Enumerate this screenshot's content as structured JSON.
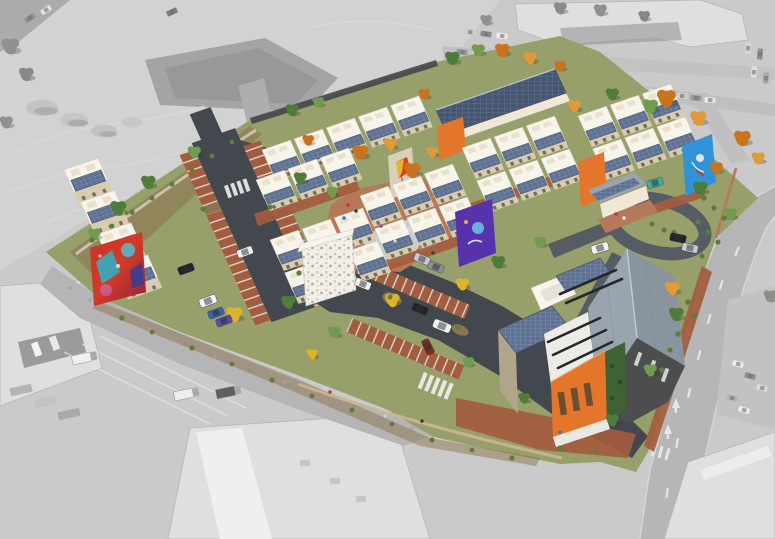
{
  "scene": {
    "type": "aerial-architectural-rendering",
    "context_style": "desaturated-grayscale-photo",
    "site_style": "full-color-rendered-development",
    "site": {
      "townhouse_clusters": 7,
      "apartment_building_left": 1,
      "community_building_corner": 1,
      "clubhouse": 1,
      "rowhouse_with_large_solar_roof": 1,
      "murals": [
        "abstract-red-teal-left",
        "purple-figure-center",
        "blue-figure-right",
        "kite-wall-center",
        "stone-mosaic-end-wall"
      ],
      "rooftop_solar_panels": true,
      "basketball_half_court": true,
      "central_plaza_with_people": true,
      "cul_de_sac_loop": true,
      "parking_lots": 2,
      "autumn_and_green_trees": true
    },
    "context": {
      "features": [
        "graded-dirt-pad-top-left",
        "commercial-building-with-parking-top-right",
        "arterial-street-right",
        "industrial-yard-with-trucks-bottom-left",
        "large-warehouse-roofs-bottom"
      ]
    }
  },
  "palette": {
    "bg_gray": "#cacaca",
    "dirt_light": "#d2d2d2",
    "pad_gray": "#a4a4a4",
    "street_gray": "#b6b6b6",
    "site_lawn": "#97a06b",
    "shrub_green": "#5e7c3e",
    "mulch_brown": "#8e7352",
    "rust_paving": "#a35c3e",
    "rust_light": "#b5795a",
    "asphalt": "#43484f",
    "asphalt_light": "#565c64",
    "court_gray": "#c7ccce",
    "cream_wall": "#f0e8d4",
    "cream_shade": "#d8ccb0",
    "roof_white": "#f7f4ec",
    "solar_blue": "#5e7191",
    "solar_grid": "#8ea0bf",
    "solar_dark": "#46566e",
    "accent_orange": "#e4762b",
    "accent_purple": "#5733ab",
    "accent_blue": "#2f93d6",
    "mural_red": "#d23a28",
    "mural_teal": "#2cb4c8",
    "mural_pink": "#d05f9e",
    "kite_orange": "#d8401e",
    "community_roof": "#9aa4ae",
    "dark_wall": "#4c4e4d",
    "tan_wall": "#b1a58b",
    "vine_green": "#3e6233",
    "trellis_dark": "#24272b",
    "tree_green": "#4e7c3a",
    "tree_green_light": "#6f9c4f",
    "tree_orange": "#c9731f",
    "tree_amber": "#e09a38",
    "tree_yellow": "#dcb32b",
    "car_white": "#f1f1f1",
    "car_black": "#22242a",
    "car_blue": "#3c62aa",
    "car_purple": "#5c4ba0",
    "car_silver": "#c8ccd0",
    "car_teal": "#3fae9b",
    "car_red": "#7a2d1c"
  }
}
